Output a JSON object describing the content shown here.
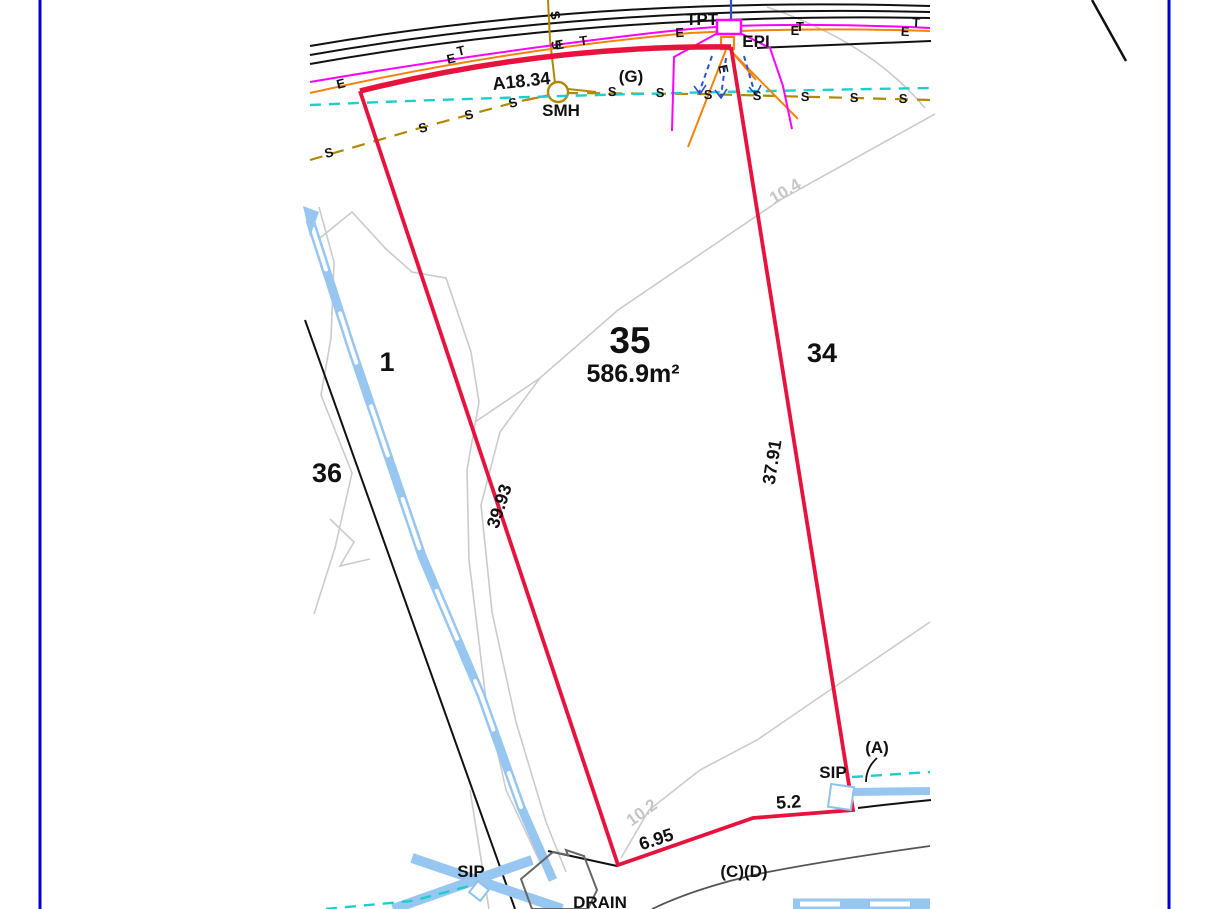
{
  "colors": {
    "frame": "#0000CC",
    "boundary_red": "#E8123F",
    "road_black": "#111111",
    "contour_gray": "#CBCBCB",
    "easement_gray": "#555555",
    "water_blue": "#97C6F0",
    "sewer_olive": "#B08900",
    "electric_orange": "#F5820B",
    "telecom_magenta": "#FF00FF",
    "drainage_cyan": "#1ECECE",
    "service_blue": "#2B50D6",
    "structure_gray": "#666666"
  },
  "plan": {
    "subject_lot": {
      "number": "35",
      "area": "586.9m²"
    },
    "adjacent_lots": {
      "left_upper": "1",
      "left_lower": "36",
      "right": "34"
    },
    "dimensions": {
      "frontage_arc": "A18.34",
      "west_boundary": "39.93",
      "east_boundary": "37.91",
      "south_west": "6.95",
      "south_east": "5.2"
    },
    "features": {
      "sewer_manhole": "SMH",
      "telecom_pit": "TPT",
      "electrical_pit": "EPI",
      "service_pit_west": "SIP",
      "service_pit_east": "SIP",
      "drain": "DRAIN"
    },
    "annotations": {
      "g": "(G)",
      "a": "(A)",
      "cd": "(C)(D)"
    },
    "contour_labels": {
      "upper": "10.4",
      "lower": "10.2"
    },
    "utility_markers": {
      "sewer": "S",
      "electric": "E",
      "telecom": "T"
    }
  }
}
